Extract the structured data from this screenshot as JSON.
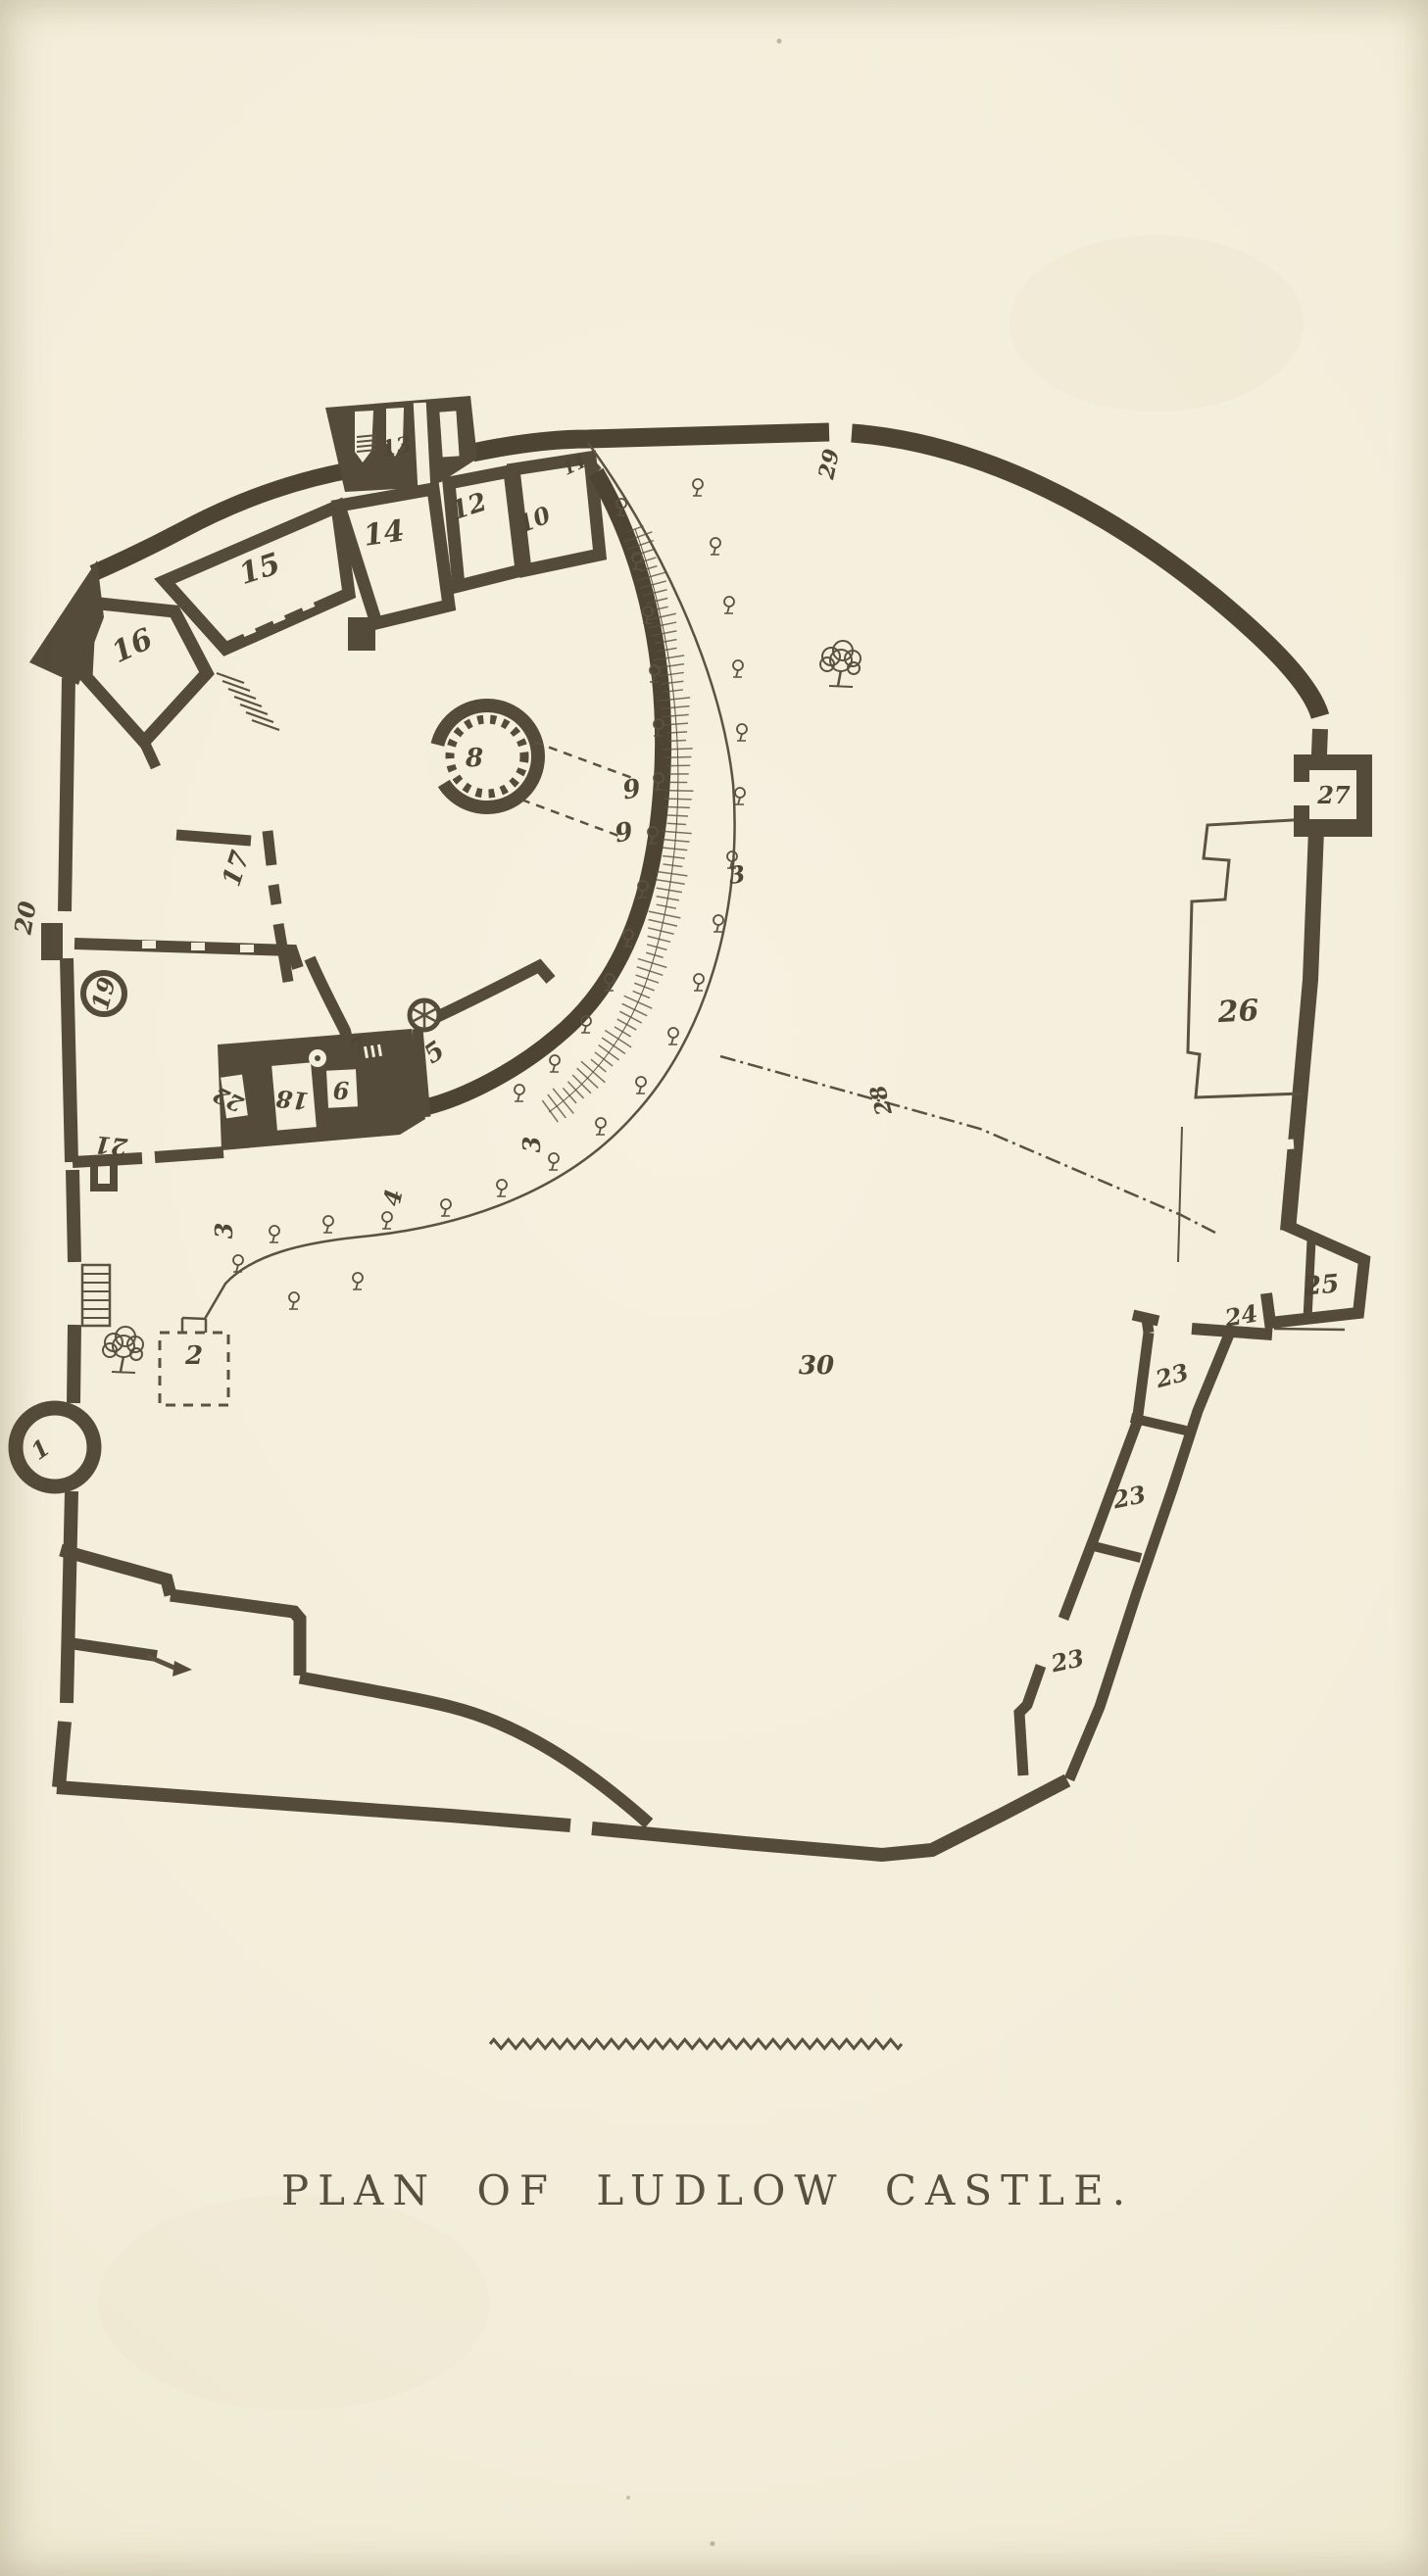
{
  "page": {
    "kind": "scanned-book-plate",
    "paper_color": "#f3eeda",
    "ink_color": "#544b3a"
  },
  "plan": {
    "caption": "PLAN OF LUDLOW CASTLE.",
    "labels": [
      {
        "name": "tower-1",
        "text": "1"
      },
      {
        "name": "room-2",
        "text": "2"
      },
      {
        "name": "fosse-3-east",
        "text": "3"
      },
      {
        "name": "fosse-3-south",
        "text": "3"
      },
      {
        "name": "fosse-3-southwest",
        "text": "3"
      },
      {
        "name": "path-4",
        "text": "4"
      },
      {
        "name": "room-5",
        "text": "5"
      },
      {
        "name": "room-6",
        "text": "6"
      },
      {
        "name": "room-7",
        "text": "7"
      },
      {
        "name": "round-chapel-8",
        "text": "8"
      },
      {
        "name": "mark-9-upper",
        "text": "9"
      },
      {
        "name": "mark-9-lower",
        "text": "9"
      },
      {
        "name": "room-10",
        "text": "10"
      },
      {
        "name": "room-11",
        "text": "11"
      },
      {
        "name": "room-12",
        "text": "12"
      },
      {
        "name": "gatehouse-13",
        "text": "13"
      },
      {
        "name": "room-14",
        "text": "14"
      },
      {
        "name": "room-15",
        "text": "15"
      },
      {
        "name": "room-16",
        "text": "16"
      },
      {
        "name": "wall-17",
        "text": "17"
      },
      {
        "name": "room-18",
        "text": "18"
      },
      {
        "name": "court-19",
        "text": "19"
      },
      {
        "name": "tower-20",
        "text": "20"
      },
      {
        "name": "wall-21",
        "text": "21"
      },
      {
        "name": "room-22",
        "text": "22"
      },
      {
        "name": "range-23-upper",
        "text": "23"
      },
      {
        "name": "range-23-middle",
        "text": "23"
      },
      {
        "name": "range-23-lower",
        "text": "23"
      },
      {
        "name": "gate-24",
        "text": "24"
      },
      {
        "name": "tower-25",
        "text": "25"
      },
      {
        "name": "range-26",
        "text": "26"
      },
      {
        "name": "tower-27",
        "text": "27"
      },
      {
        "name": "line-28",
        "text": "28"
      },
      {
        "name": "gap-29",
        "text": "29"
      },
      {
        "name": "outer-bailey-30",
        "text": "30"
      }
    ]
  }
}
